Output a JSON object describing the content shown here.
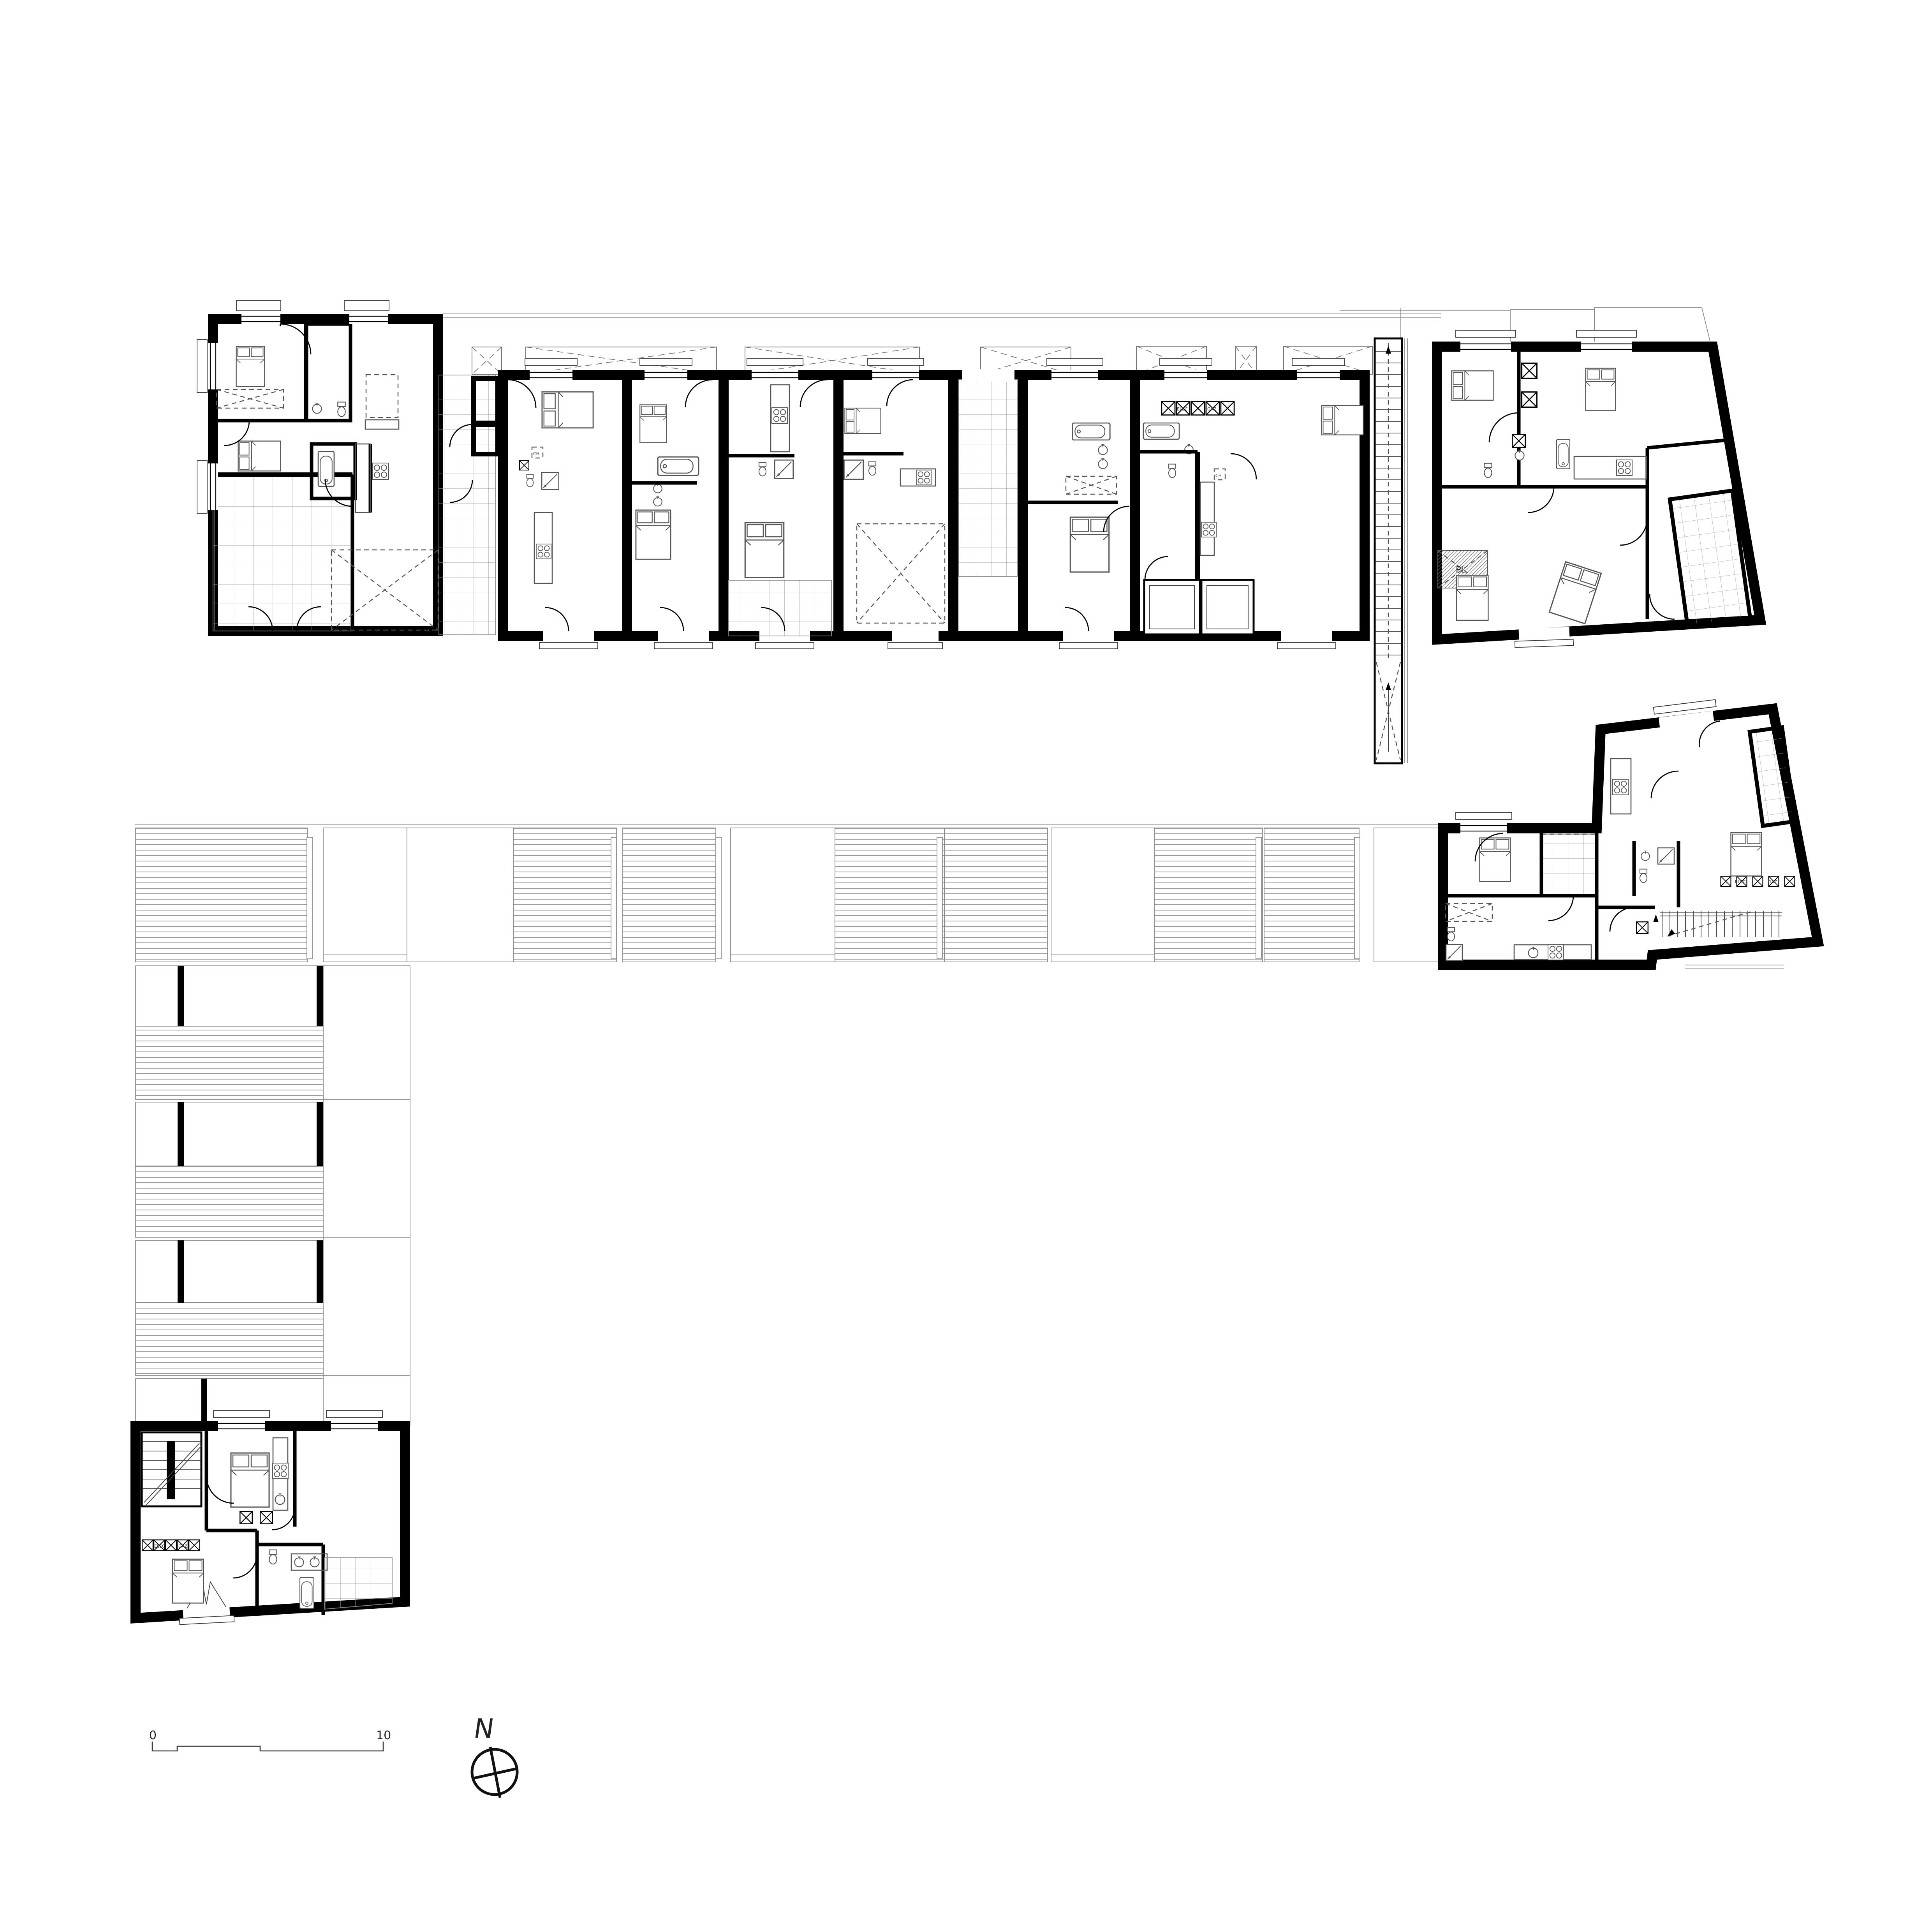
{
  "page": {
    "background_color": "#ffffff",
    "description": "Black-and-white architectural floor plan: a long bar of apartment units at top, an L-shaped timber deck band, two detached dwelling units, scale bar and north arrow"
  },
  "scale_bar": {
    "start_label": "0",
    "end_label": "10"
  },
  "compass": {
    "north_label": "N"
  },
  "labels": {
    "closet": "PL",
    "chute": "CH",
    "meter_electric": "ELEC",
    "meter_gas": "GAZ"
  },
  "colors": {
    "wall": "#000000",
    "furniture_line": "#555555",
    "light_line": "#8a8a8a",
    "tile_line": "#a3a3a3",
    "deck_line": "#7a7a7a",
    "dashed_line": "#777777",
    "background": "#ffffff"
  }
}
